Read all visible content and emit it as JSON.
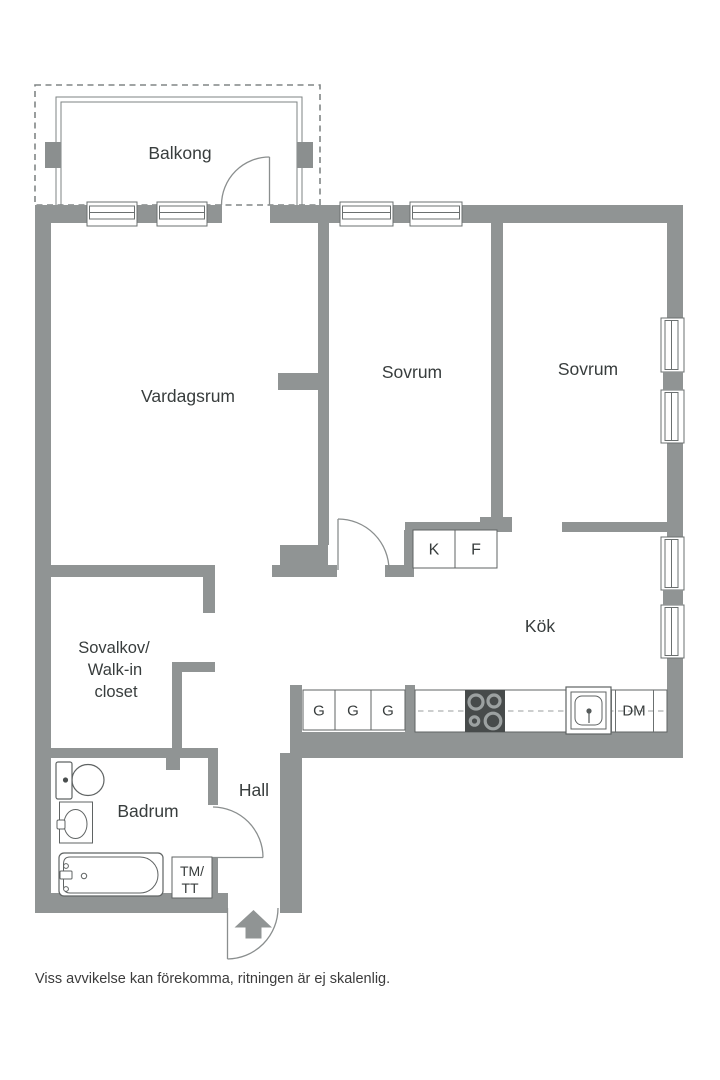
{
  "rooms": {
    "balcony": "Balkong",
    "living_room": "Vardagsrum",
    "bedroom_1": "Sovrum",
    "bedroom_2": "Sovrum",
    "kitchen": "Kök",
    "closet_line1": "Sovalkov/",
    "closet_line2": "Walk-in",
    "closet_line3": "closet",
    "bathroom": "Badrum",
    "hall": "Hall"
  },
  "appliances": {
    "fridge": "K",
    "freezer": "F",
    "wardrobe_1": "G",
    "wardrobe_2": "G",
    "wardrobe_3": "G",
    "dishwasher": "DM",
    "washer_line1": "TM/",
    "washer_line2": "TT"
  },
  "footer": {
    "disclaimer": "Viss avvikelse kan förekomma, ritningen är ej skalenlig."
  },
  "colors": {
    "wall": "#909494",
    "line": "#6b7070",
    "fixture": "#5f6363",
    "door": "#8a8e8e",
    "text": "#383d3d",
    "stove": "#474b4b",
    "background": "#ffffff"
  }
}
